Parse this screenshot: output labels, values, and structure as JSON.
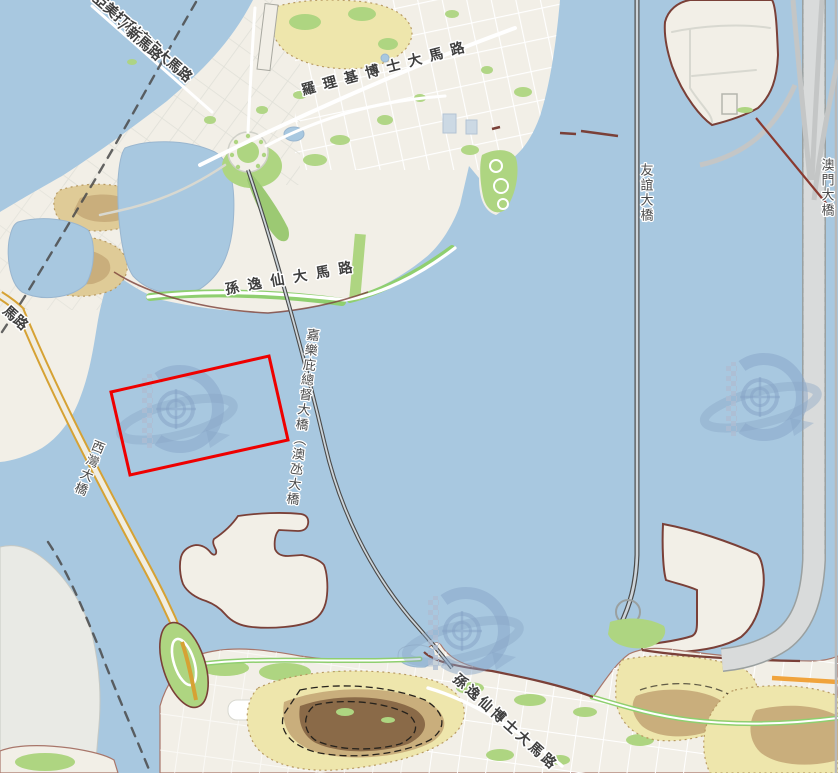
{
  "map": {
    "title": "Macau harbour map view",
    "labels": {
      "almeida_ribeiro": "亞美打利庇盧大馬路",
      "san_ma_lo": "/ 新馬路",
      "rodrigo_rodrigues": "羅理基博士大馬路",
      "sun_yat_sen": "孫逸仙大馬路",
      "nobre_bridge": "嘉樂庇總督大橋（澳氹大橋",
      "sai_van_bridge": "西灣大橋",
      "friendship_bridge": "友誼大橋",
      "macau_bridge": "澳門大橋",
      "sun_yat_sen_taipa": "孫逸仙博士大馬路",
      "road_partial": "馬路"
    },
    "annotation": {
      "shape": "rotated-rectangle",
      "color": "#ee0000",
      "points": "111,392 269,356 288,440 130,475"
    },
    "icons": {
      "watermark": "saturn-ring-d-logo"
    },
    "colors": {
      "water": "#a8c8e0",
      "land": "#f2efe7",
      "foreign_land": "#e9eae5",
      "park": "#aed581",
      "hill_pale": "#eee6ac",
      "hill_tan": "#c9ae7c",
      "hill_brown": "#8a6a48",
      "bridge_yellow": "#d6a234",
      "road_orange": "#f0a33c",
      "seawall": "#7a4038",
      "boundary": "#4a4a4a",
      "annotation_red": "#ee0000",
      "watermark_blue": "#86a4c6"
    }
  }
}
